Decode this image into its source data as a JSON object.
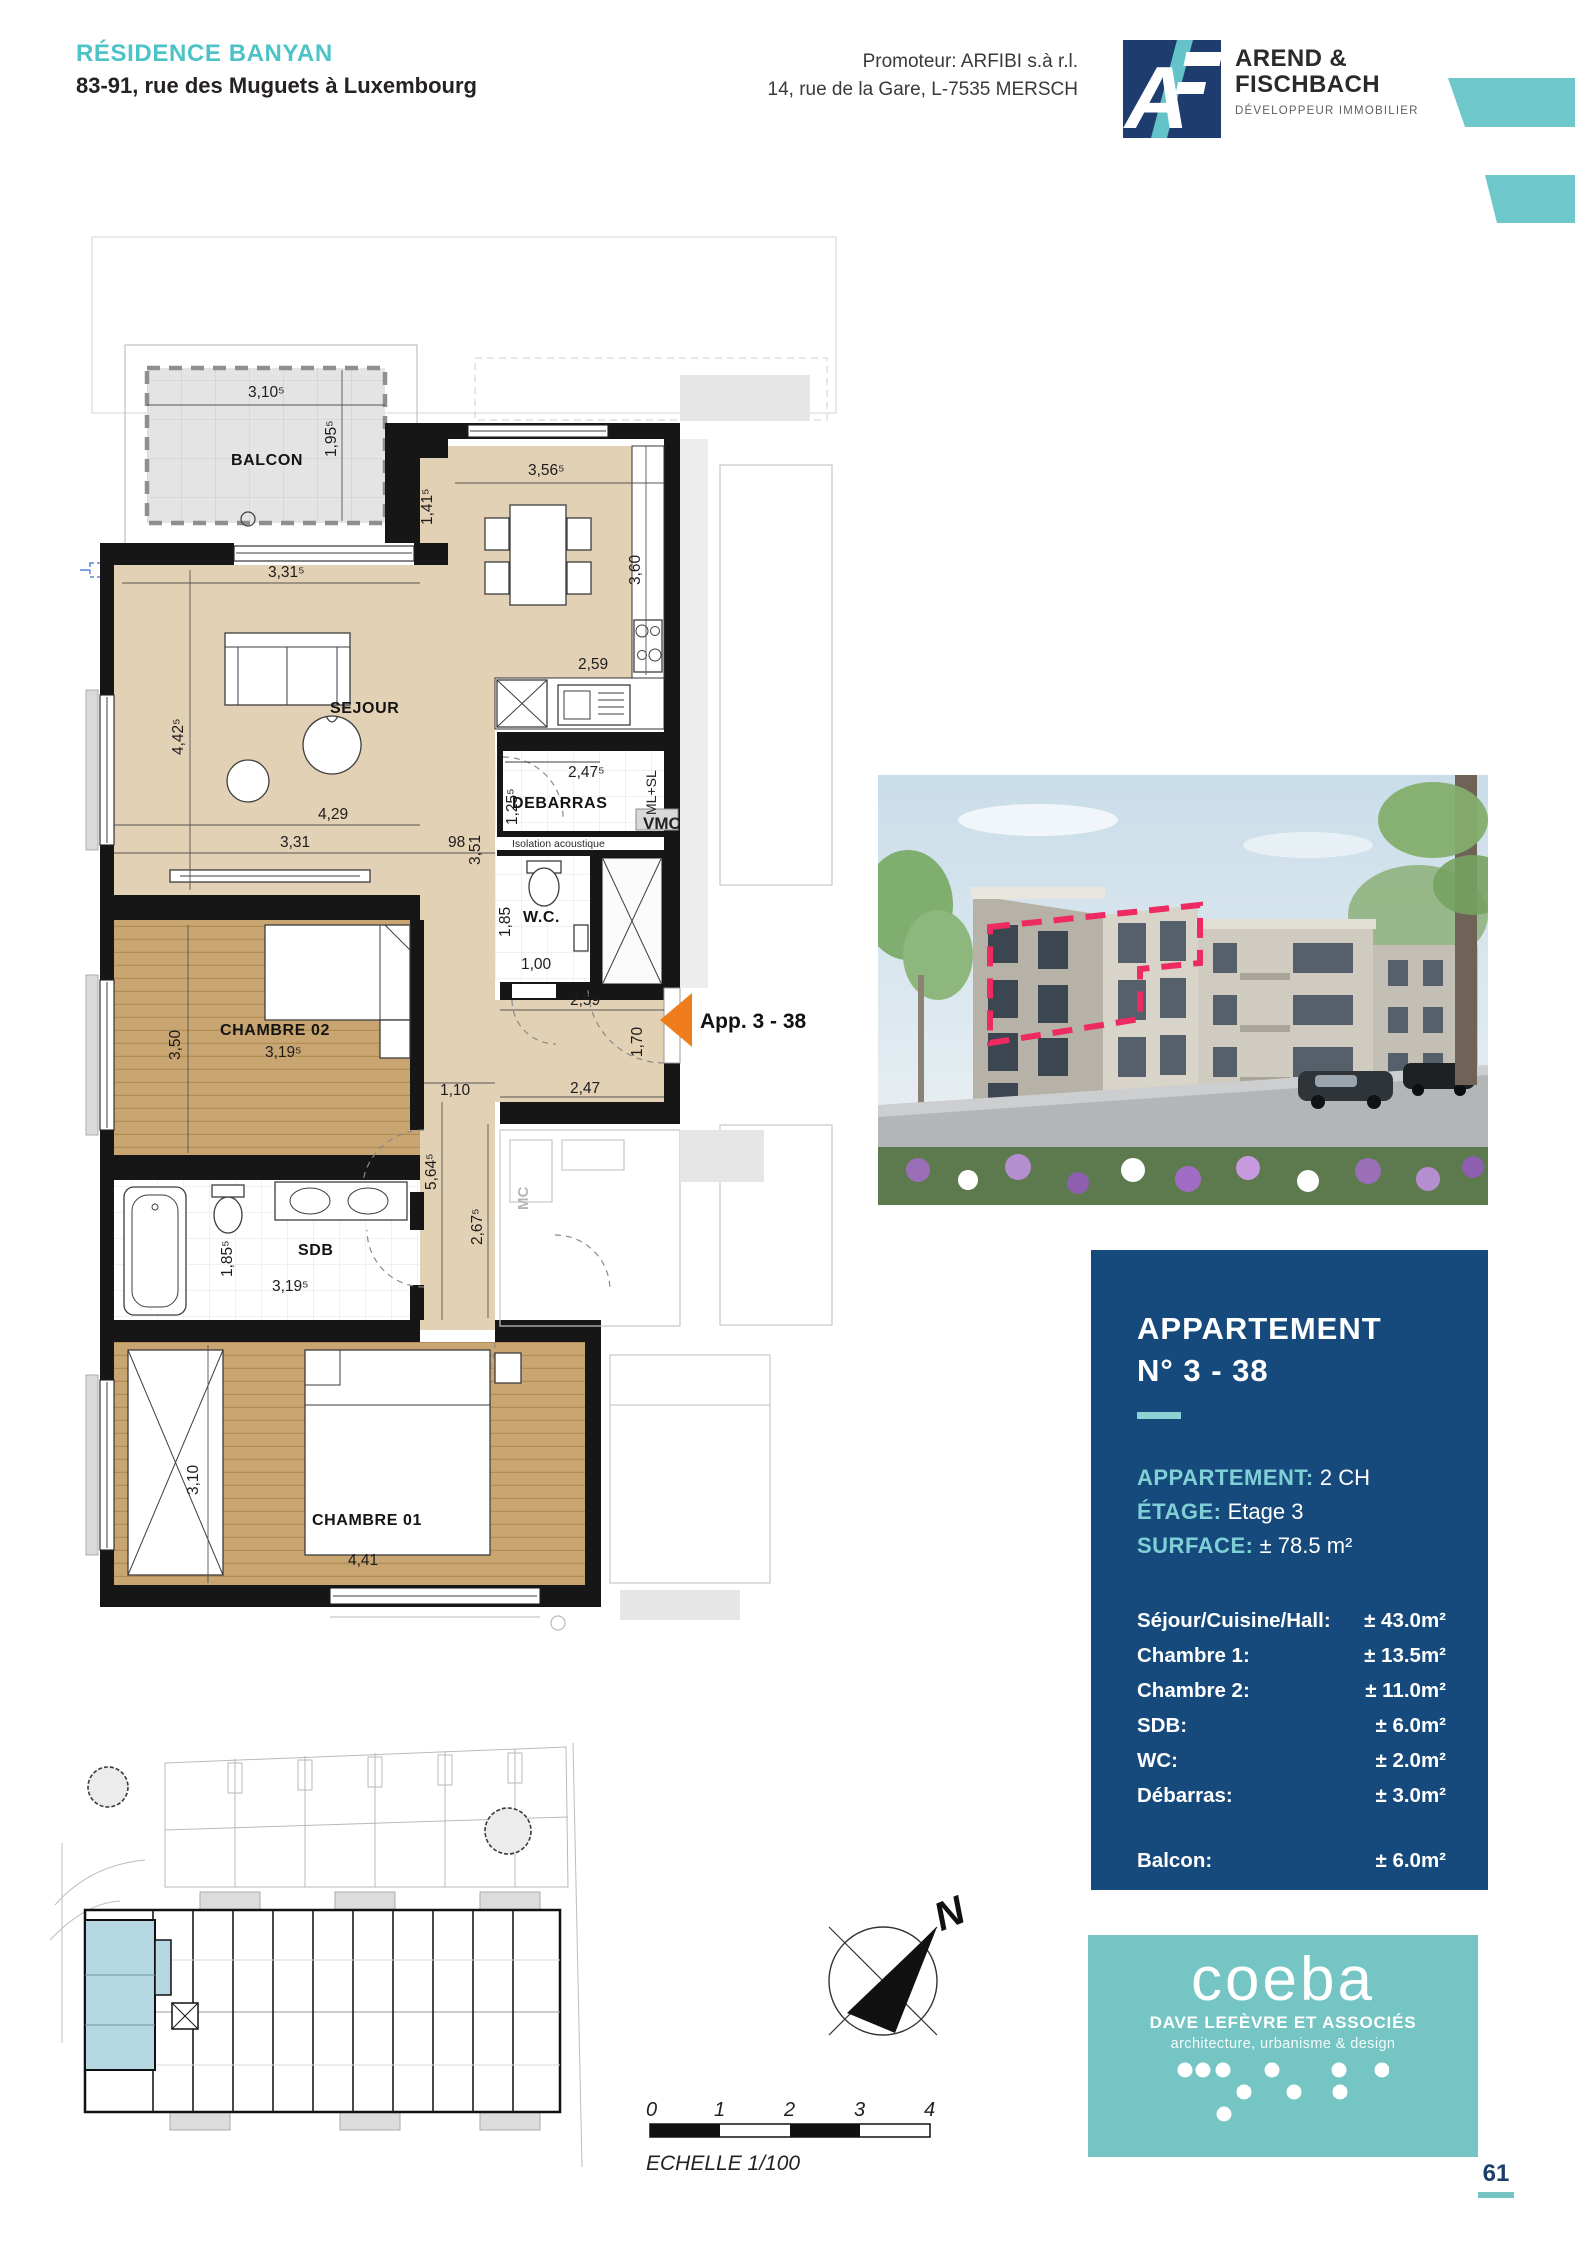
{
  "header": {
    "project_name": "RÉSIDENCE BANYAN",
    "project_address": "83-91, rue des Muguets à Luxembourg",
    "promoter_line1": "Promoteur: ARFIBI s.à r.l.",
    "promoter_line2": "14, rue de la Gare, L-7535 MERSCH",
    "logo": {
      "monogram": "A",
      "name_line1": "AREND &",
      "name_line2": "FISCHBACH",
      "tagline": "DÉVELOPPEUR IMMOBILIER"
    },
    "accent_color": "#6ec7ca"
  },
  "floor_plan": {
    "rooms": {
      "balcon": "BALCON",
      "sejour": "SEJOUR",
      "debarras": "DEBARRAS",
      "wc": "W.C.",
      "chambre02": "CHAMBRE 02",
      "sdb": "SDB",
      "chambre01": "CHAMBRE 01"
    },
    "annotations": {
      "vmc": "VMC",
      "ml_sl": "ML+SL",
      "isolation": "Isolation acoustique",
      "neighbor": "MC",
      "entrance": "App. 3 - 38"
    },
    "dims": {
      "balcon_w": "3,10⁵",
      "balcon_d": "1,95⁵",
      "sejour_top": "3,31⁵",
      "kitchen_w": "3,56⁵",
      "kitchen_off": "1,41⁵",
      "kitchen_h": "3,60",
      "kitchen_low": "2,59",
      "sejour_h": "4,42⁵",
      "sejour_w": "4,29",
      "sejour_w2": "3,31",
      "hall_98": "98",
      "hall_351": "3,51",
      "debarras_w": "2,47⁵",
      "debarras_h": "1,25⁵",
      "wc_h": "1,85",
      "wc_w": "1,00",
      "ch2_h": "3,50",
      "ch2_w": "3,19⁵",
      "hall_110": "1,10",
      "hall_564": "5,64⁵",
      "hall_267": "2,67⁵",
      "entry_top": "2,59",
      "entry_door": "1,70",
      "entry_bottom": "2,47",
      "sdb_h": "1,85⁵",
      "sdb_w": "3,19⁵",
      "ch1_h": "3,10",
      "ch1_w": "4,41"
    },
    "colors": {
      "floor": "#e3d1b5",
      "wood": "#c9a671",
      "wall": "#161616",
      "arrow": "#ef7d1b"
    }
  },
  "photo": {
    "description": "building-render-with-unit-outline",
    "outline_color": "#ee2a62"
  },
  "info_panel": {
    "title_line1": "APPARTEMENT",
    "title_line2": "N° 3 - 38",
    "specs": [
      {
        "label": "APPARTEMENT:",
        "value": "2 CH"
      },
      {
        "label": "ÉTAGE:",
        "value": "Etage 3"
      },
      {
        "label": "SURFACE:",
        "value": "± 78.5 m²"
      }
    ],
    "rooms": [
      {
        "name": "Séjour/Cuisine/Hall:",
        "area": "± 43.0m²"
      },
      {
        "name": "Chambre 1:",
        "area": "± 13.5m²"
      },
      {
        "name": "Chambre 2:",
        "area": "± 11.0m²"
      },
      {
        "name": "SDB:",
        "area": "± 6.0m²"
      },
      {
        "name": "WC:",
        "area": "± 2.0m²"
      },
      {
        "name": "Débarras:",
        "area": "± 3.0m²"
      }
    ],
    "balcony_row": {
      "name": "Balcon:",
      "area": "± 6.0m²"
    },
    "bg_color": "#174a7c",
    "label_color": "#7fd0d6"
  },
  "site_plan": {
    "highlight_color": "#b4d7e2"
  },
  "compass": {
    "north_label": "N"
  },
  "scale_bar": {
    "ticks": [
      "0",
      "1",
      "2",
      "3",
      "4"
    ],
    "caption": "ECHELLE  1/100"
  },
  "coeba": {
    "name": "coeba",
    "line1": "DAVE LEFÈVRE ET ASSOCIÉS",
    "line2": "architecture, urbanisme & design",
    "bg_color": "#74c5c3"
  },
  "page_number": "61"
}
